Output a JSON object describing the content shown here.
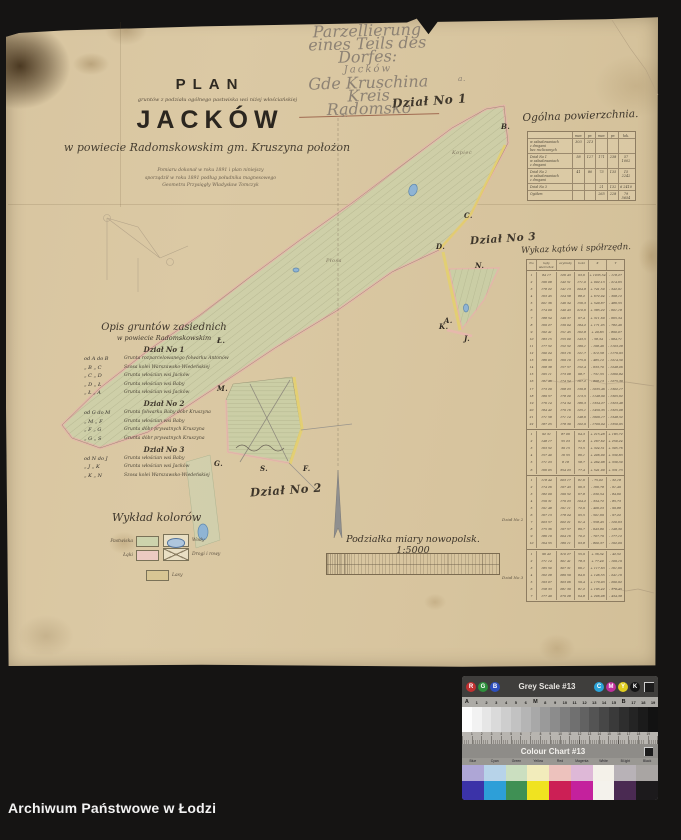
{
  "watermark": {
    "text": "Archiwum Państwowe w Łodzi"
  },
  "pencil_note": {
    "lines": [
      "Parzellierung",
      "eines Teils des Dorfes:",
      "Jacków",
      "Gde Kruschina",
      "Kreis Radomsko"
    ]
  },
  "section_labels": {
    "dzial1": "Dział No 1",
    "dzial2": "Dział No 2",
    "dzial3": "Dział No 3"
  },
  "title_block": {
    "plan": "PLAN",
    "subtitle_small": "gruntów z podziału ogólnego pastwiska wsi niżej włościańskiej",
    "village": "JACKÓW",
    "subtitle_script": "w powiecie Radomskowskim gm. Kruszyna położon",
    "note_line1": "Pomiaru dokonał w roku 1891 i plan niniejszy",
    "note_line2": "sporządził w roku 1891 podług południka magnesowego",
    "note_line3": "Geometra Przysięgły Władysław Tomczyk"
  },
  "area_table": {
    "title": "Ogólna powierzchnia.",
    "col_headers": [
      "",
      "mor.",
      "pr.",
      "mor.",
      "pr.",
      "łok."
    ],
    "rows": [
      {
        "label": "w zabudowaniach\nz drogami\nbez rozliczonych",
        "values": [
          "303",
          "213",
          "",
          "",
          ""
        ]
      },
      {
        "label": "Dział No 1\nw zabudowaniach\nz drogami",
        "values": [
          "58",
          "127",
          "171",
          "238",
          "57 1002"
        ]
      },
      {
        "label": "Dział No 2\nw zabudowaniach\nz drogami",
        "values": [
          "41",
          "80",
          "73",
          "135",
          "15 2242"
        ]
      },
      {
        "label": "Dział No 3",
        "values": [
          "",
          "",
          "21",
          "132",
          "6 2410"
        ]
      },
      {
        "label": "Ogółem",
        "values": [
          "",
          "",
          "265",
          "228",
          "79 5654"
        ]
      }
    ]
  },
  "angles_table": {
    "title": "Wykaz kątów i spółrzędn.",
    "headers": {
      "no": "No",
      "katy": "kąty wierzchoł.",
      "azymuty": "azymuty",
      "boki": "boki",
      "wspolrzedne": "spółrzędne",
      "x": "X",
      "y": "Y"
    },
    "margin_labels": [
      "Dział No 2",
      "Dział No 3"
    ],
    "groups": [
      {
        "rows": [
          [
            "1",
            "84 17",
            "126 43",
            "93,6",
            "+ 1035,54",
            "- 118,27"
          ],
          [
            "2",
            "196 08",
            "142 51",
            "171,0",
            "+ 902,13",
            "- 214,65"
          ],
          [
            "3",
            "178 22",
            "141 13",
            "204,8",
            "+ 741,50",
            "- 342,91"
          ],
          [
            "4",
            "163 45",
            "124 58",
            "88,2",
            "+ 672,04",
            "- 398,12"
          ],
          [
            "5",
            "201 36",
            "146 34",
            "156,3",
            "+ 549,87",
            "- 486,55"
          ],
          [
            "6",
            "174 09",
            "140 43",
            "210,6",
            "+ 385,22",
            "- 601,18"
          ],
          [
            "7",
            "188 54",
            "149 37",
            "97,4",
            "+ 311,69",
            "- 665,34"
          ],
          [
            "8",
            "169 27",
            "139 04",
            "184,2",
            "+ 171,05",
            "- 782,46"
          ],
          [
            "9",
            "192 41",
            "151 45",
            "162,8",
            "+ 49,83",
            "- 890,07"
          ],
          [
            "10",
            "183 15",
            "155 00",
            "143,5",
            "- 58,34",
            "- 984,71"
          ],
          [
            "11",
            "177 52",
            "152 52",
            "189,1",
            "- 198,46",
            "- 1103,28"
          ],
          [
            "12",
            "190 24",
            "163 16",
            "121,7",
            "- 312,58",
            "- 1179,93"
          ],
          [
            "13",
            "186 03",
            "169 19",
            "175,9",
            "- 485,12",
            "- 1214,50"
          ],
          [
            "14",
            "168 38",
            "157 57",
            "152,4",
            "- 633,70",
            "- 1248,06"
          ],
          [
            "15",
            "195 11",
            "173 08",
            "98,7",
            "- 731,55",
            "- 1260,84"
          ],
          [
            "16",
            "181 46",
            "174 54",
            "167,2",
            "- 898,13",
            "- 1275,39"
          ],
          [
            "17",
            "173 29",
            "168 23",
            "139,8",
            "- 1035,46",
            "- 1302,17"
          ],
          [
            "18",
            "189 57",
            "178 20",
            "113,5",
            "- 1148,90",
            "- 1305,62"
          ],
          [
            "19",
            "176 14",
            "174 34",
            "186,3",
            "- 1334,27",
            "- 1323,48"
          ],
          [
            "20",
            "184 42",
            "179 16",
            "125,1",
            "- 1459,35",
            "- 1325,08"
          ],
          [
            "21",
            "171 58",
            "171 14",
            "148,6",
            "- 1606,17",
            "- 1348,52"
          ],
          [
            "22",
            "187 25",
            "178 39",
            "102,9",
            "- 1709,04",
            "- 1350,95"
          ]
        ]
      },
      {
        "rows": [
          [
            "1",
            "92 31",
            "87 06",
            "64,3",
            "+ 215,48",
            "+ 183,72"
          ],
          [
            "2",
            "148 17",
            "55 23",
            "91,8",
            "+ 267,62",
            "+ 259,24"
          ],
          [
            "3",
            "163 52",
            "39 15",
            "73,5",
            "+ 324,51",
            "+ 305,76"
          ],
          [
            "4",
            "157 40",
            "16 55",
            "86,1",
            "+ 406,90",
            "+ 330,83"
          ],
          [
            "5",
            "171 23",
            "8 18",
            "58,7",
            "+ 464,98",
            "+ 339,30"
          ],
          [
            "6",
            "166 05",
            "354 23",
            "77,4",
            "+ 541,99",
            "+ 331,73"
          ]
        ]
      },
      {
        "rows": [
          [
            "1",
            "118 44",
            "203 17",
            "81,6",
            "- 75,02",
            "- 32,18"
          ],
          [
            "2",
            "174 26",
            "197 43",
            "96,3",
            "- 166,78",
            "- 61,49"
          ],
          [
            "3",
            "182 09",
            "199 52",
            "67,8",
            "- 230,54",
            "- 84,60"
          ],
          [
            "4",
            "159 31",
            "179 23",
            "104,2",
            "- 334,72",
            "- 85,73"
          ],
          [
            "5",
            "191 48",
            "191 11",
            "72,9",
            "- 406,23",
            "- 99,88"
          ],
          [
            "6",
            "167 13",
            "178 24",
            "95,5",
            "- 501,69",
            "- 97,22"
          ],
          [
            "7",
            "203 57",
            "202 21",
            "61,4",
            "- 558,45",
            "- 120,63"
          ],
          [
            "8",
            "175 36",
            "197 57",
            "89,7",
            "- 643,80",
            "- 148,30"
          ],
          [
            "9",
            "186 19",
            "204 16",
            "70,2",
            "- 707,79",
            "- 177,12"
          ],
          [
            "10",
            "164 55",
            "189 11",
            "93,8",
            "- 800,37",
            "- 192,09"
          ]
        ]
      },
      {
        "rows": [
          [
            "1",
            "96 42",
            "310 27",
            "55,9",
            "+ 36,34",
            "- 42,52"
          ],
          [
            "2",
            "171 14",
            "301 41",
            "78,3",
            "+ 77,40",
            "- 109,19"
          ],
          [
            "3",
            "185 50",
            "307 31",
            "66,1",
            "+ 117,63",
            "- 161,66"
          ],
          [
            "4",
            "162 28",
            "289 59",
            "84,6",
            "+ 146,55",
            "- 241,16"
          ],
          [
            "5",
            "193 07",
            "303 06",
            "59,4",
            "+ 179,03",
            "- 290,92"
          ],
          [
            "6",
            "158 33",
            "281 39",
            "81,2",
            "+ 195,42",
            "- 370,45"
          ],
          [
            "7",
            "177 49",
            "279 28",
            "64,8",
            "+ 206,08",
            "- 434,38"
          ]
        ]
      }
    ]
  },
  "neighbors_legend": {
    "title": "Opis gruntów zasiednich",
    "subtitle": "w powiecie Radomskowskim",
    "sections": [
      {
        "label": "Dział No 1",
        "items": [
          {
            "pair": "od A do B",
            "desc": "Grunta rozparcelowanego folwarku Antonów"
          },
          {
            "pair": "„ B „ C",
            "desc": "Szosa kolei Warszawsko-Wiedeńskiej"
          },
          {
            "pair": "„ C „ D",
            "desc": "Grunta włościan wsi Jacków"
          },
          {
            "pair": "„ D „ Ł",
            "desc": "Grunta włościan wsi Baby"
          },
          {
            "pair": "„ Ł „ A",
            "desc": "Grunta włościan wsi Jacków"
          }
        ]
      },
      {
        "label": "Dział No 2",
        "items": [
          {
            "pair": "od G do M",
            "desc": "Grunta folwarku Baby dóbr Kruszyna"
          },
          {
            "pair": "„ M „ F",
            "desc": "Grunta włościan wsi Baby"
          },
          {
            "pair": "„ F „ G",
            "desc": "Grunta dóbr prywatnych Kruszyna"
          },
          {
            "pair": "„ G „ S",
            "desc": "Grunta dóbr prywatnych Kruszyna"
          }
        ]
      },
      {
        "label": "Dział No 3",
        "items": [
          {
            "pair": "od N do J",
            "desc": "Grunta włościan wsi Baby"
          },
          {
            "pair": "„ J „ K",
            "desc": "Grunta włościan wsi Jacków"
          },
          {
            "pair": "„ K „ N",
            "desc": "Szosa kolei Warszawsko-Wiedeńskiej"
          }
        ]
      }
    ]
  },
  "color_legend": {
    "title": "Wykład kolorów",
    "items": [
      {
        "label": "Pastwiska",
        "type": "swatch",
        "color": "#cdd3ac",
        "sx": 136,
        "sy": 536,
        "lx": 102,
        "ly": 539,
        "side": "left"
      },
      {
        "label": "Wody",
        "type": "ellipse",
        "color": "#aec6dd",
        "sx": 163,
        "sy": 534,
        "lx": 192,
        "ly": 538,
        "side": "right"
      },
      {
        "label": "Łąki",
        "type": "swatch",
        "color": "#eccac2",
        "sx": 136,
        "sy": 550,
        "lx": 102,
        "ly": 553,
        "side": "left"
      },
      {
        "label": "Drogi i rowy",
        "type": "cross",
        "color": "#e3d9bd",
        "sx": 163,
        "sy": 548,
        "lx": 192,
        "ly": 552,
        "side": "right"
      },
      {
        "label": "Lasy",
        "type": "swatch",
        "color": "#d8c694",
        "sx": 146,
        "sy": 570,
        "lx": 172,
        "ly": 573,
        "side": "right"
      }
    ]
  },
  "scale": {
    "label": "Podziałka miary nowopolsk. 1:5000"
  },
  "map_letters": [
    {
      "t": "a.",
      "x": 458,
      "y": 74,
      "cls": "pencil"
    },
    {
      "t": "s.",
      "x": 341,
      "y": 110,
      "cls": "pencil"
    },
    {
      "t": "B.",
      "x": 501,
      "y": 122
    },
    {
      "t": "C.",
      "x": 464,
      "y": 211
    },
    {
      "t": "D.",
      "x": 436,
      "y": 242
    },
    {
      "t": "A.",
      "x": 444,
      "y": 316
    },
    {
      "t": "N.",
      "x": 475,
      "y": 261
    },
    {
      "t": "K.",
      "x": 439,
      "y": 322
    },
    {
      "t": "J.",
      "x": 464,
      "y": 334
    },
    {
      "t": "Ł.",
      "x": 217,
      "y": 336
    },
    {
      "t": "M.",
      "x": 217,
      "y": 384
    },
    {
      "t": "G.",
      "x": 214,
      "y": 459
    },
    {
      "t": "S.",
      "x": 260,
      "y": 464
    },
    {
      "t": "F.",
      "x": 303,
      "y": 464
    },
    {
      "t": "Płosa",
      "x": 326,
      "y": 258,
      "cls": "faint"
    },
    {
      "t": "Kopiec",
      "x": 452,
      "y": 150,
      "cls": "faint"
    }
  ],
  "calibration": {
    "grey_title": "Grey Scale #13",
    "chart_title": "Colour Chart #13",
    "rgb": [
      {
        "label": "R",
        "color": "#c13030"
      },
      {
        "label": "G",
        "color": "#2e8f3c"
      },
      {
        "label": "B",
        "color": "#2d4fbd"
      }
    ],
    "cmyk": [
      {
        "label": "C",
        "color": "#2ba3d8"
      },
      {
        "label": "M",
        "color": "#bf2f9b"
      },
      {
        "label": "Y",
        "color": "#e0cd20"
      },
      {
        "label": "K",
        "color": "#141414"
      }
    ],
    "grey_labels": [
      "A",
      "1",
      "2",
      "3",
      "4",
      "5",
      "6",
      "M",
      "8",
      "9",
      "10",
      "11",
      "12",
      "13",
      "14",
      "15",
      "B",
      "17",
      "18",
      "19"
    ],
    "grey_steps": [
      "#fdfdfd",
      "#f2f2f2",
      "#e6e6e6",
      "#dadada",
      "#cecece",
      "#c2c2c2",
      "#b5b5b5",
      "#a8a8a8",
      "#9a9a9a",
      "#8c8c8c",
      "#7e7e7e",
      "#707070",
      "#626262",
      "#545454",
      "#474747",
      "#3a3a3a",
      "#2e2e2e",
      "#242424",
      "#1b1b1b",
      "#121212"
    ],
    "ruler_numbers": [
      "1",
      "2",
      "3",
      "4",
      "5",
      "6",
      "7",
      "8",
      "9",
      "10",
      "11",
      "12",
      "13",
      "14",
      "15",
      "16",
      "17",
      "18",
      "19"
    ],
    "columns": [
      {
        "label": "Blue",
        "light": "#aea6d6",
        "full": "#3b33a8"
      },
      {
        "label": "Cyan",
        "light": "#b7d3e9",
        "full": "#2d9fd8"
      },
      {
        "label": "Green",
        "light": "#cbdfc0",
        "full": "#3f9054"
      },
      {
        "label": "Yellow",
        "light": "#f2ecbb",
        "full": "#f0e320"
      },
      {
        "label": "Red",
        "light": "#edc2bd",
        "full": "#cc1f55"
      },
      {
        "label": "Magenta",
        "light": "#deb8d7",
        "full": "#c4219d"
      },
      {
        "label": "White",
        "light": "#f4f1e9",
        "full": "#f4f2ec"
      },
      {
        "label": "Bl.lght",
        "light": "#b8b2b7",
        "full": "#4a2a52"
      },
      {
        "label": "Black",
        "light": "#a9a5a3",
        "full": "#1c1a1c"
      }
    ]
  }
}
